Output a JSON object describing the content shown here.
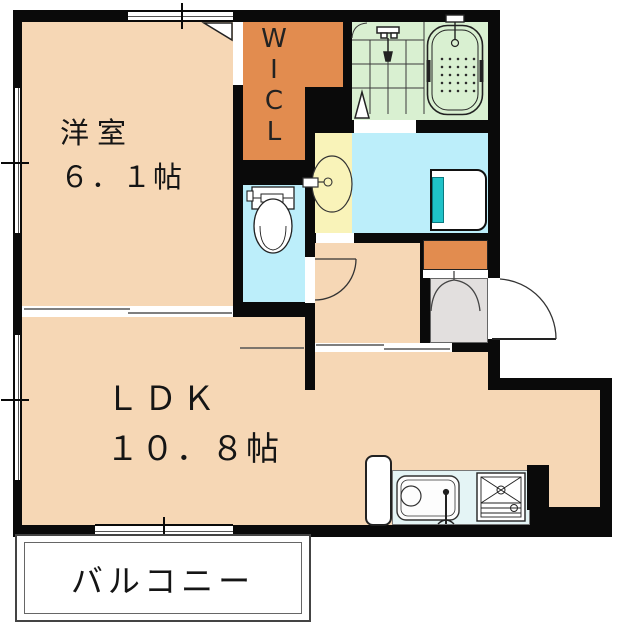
{
  "plan": {
    "title": "apartment-floor-plan",
    "rooms": {
      "western_room": {
        "name": "洋室",
        "size": "６．１帖"
      },
      "ldk": {
        "name": "ＬＤＫ",
        "size": "１０．８帖"
      },
      "balcony": {
        "name": "バルコニー"
      },
      "wicl": {
        "letters": [
          "W",
          "I",
          "C",
          "L"
        ]
      }
    },
    "fixtures": [
      "bathtub",
      "bath-faucet",
      "shower",
      "tiled-bath-floor",
      "washbasin",
      "washbasin-faucet",
      "toilet",
      "washing-machine-pan",
      "shoe-cabinet",
      "entrance-step",
      "front-door",
      "toilet-door",
      "sliding-partition",
      "hall-sliding-door",
      "kitchen-sink",
      "kitchen-faucet",
      "gas-stove",
      "refrigerator",
      "windows",
      "opening-markers",
      "dimension-ticks"
    ],
    "colors": {
      "room_peach": "#F6D7B5",
      "closet_orange": "#E28C4F",
      "bath_green": "#D9F0D1",
      "wet_area_cyan": "#BCEEFA",
      "basin_yellow": "#F9F3B9",
      "pan_teal": "#1FC2C8",
      "entry_gray": "#E2DFDE",
      "counter_blue": "#E4F4F5",
      "wall_black": "#0A0A0A"
    }
  }
}
